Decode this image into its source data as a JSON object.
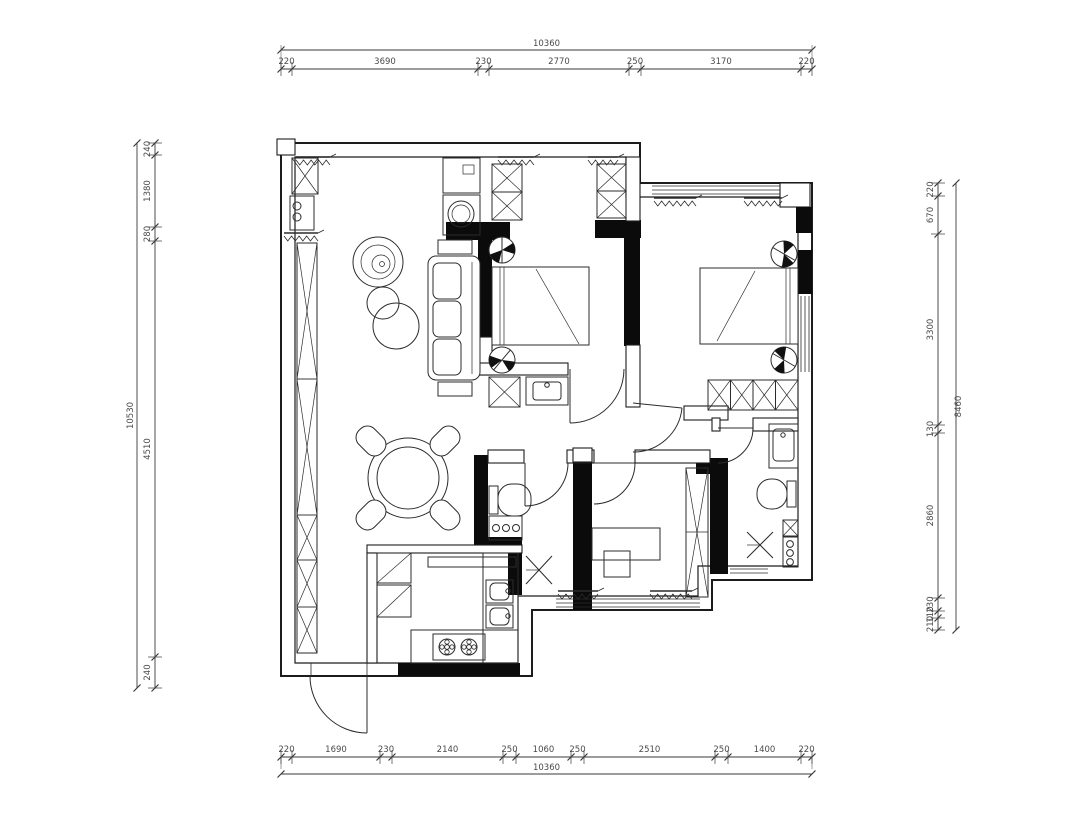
{
  "drawing": {
    "type": "residential apartment floor plan",
    "units": "mm",
    "colors": {
      "background": "#ffffff",
      "lines": "#2b2b2b",
      "walls": "#0b0b0b",
      "dim_text": "#4a4a4a"
    }
  },
  "dims": {
    "top": {
      "total": "10360",
      "segments": [
        "220",
        "3690",
        "230",
        "2770",
        "250",
        "3170",
        "220"
      ]
    },
    "bottom": {
      "total": "10360",
      "segments": [
        "220",
        "1690",
        "230",
        "2140",
        "250",
        "1060",
        "250",
        "2510",
        "250",
        "1400",
        "220"
      ]
    },
    "left": {
      "total": "10530",
      "segments": [
        "240",
        "1380",
        "280",
        "4510",
        "240"
      ]
    },
    "right": {
      "total": "8460",
      "segments": [
        "220",
        "670",
        "3300",
        "130",
        "2860",
        "230",
        "110",
        "210"
      ]
    }
  }
}
